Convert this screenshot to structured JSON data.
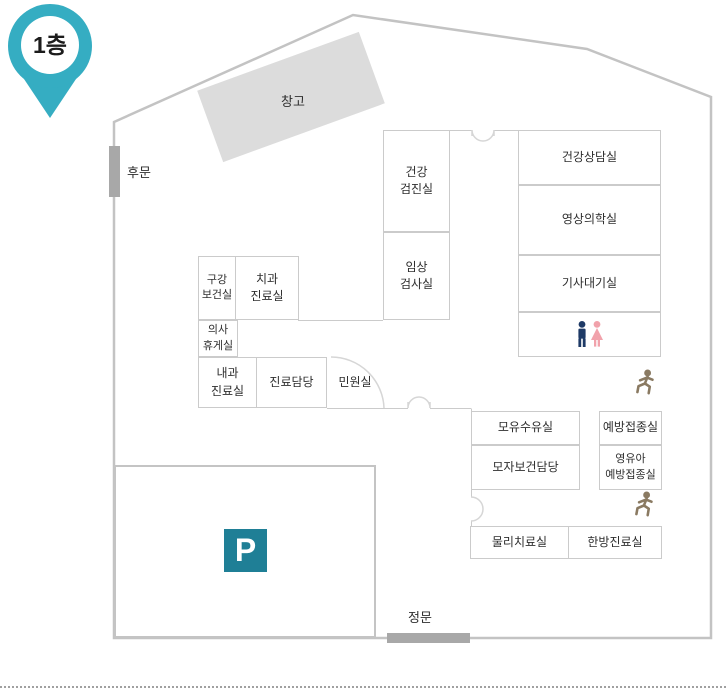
{
  "pin": {
    "label": "1층"
  },
  "storage": {
    "label": "창고"
  },
  "gates": {
    "back": "후문",
    "front": "정문"
  },
  "parking": {
    "symbol": "P"
  },
  "rooms": [
    {
      "label": "건강\n검진실"
    },
    {
      "label": "임상\n검사실"
    },
    {
      "label": "건강상담실"
    },
    {
      "label": "영상의학실"
    },
    {
      "label": "기사대기실"
    },
    {
      "label": "구강\n보건실"
    },
    {
      "label": "치과\n진료실"
    },
    {
      "label": "의사\n휴게실"
    },
    {
      "label": "내과\n진료실"
    },
    {
      "label": "진료담당"
    },
    {
      "label": "민원실"
    },
    {
      "label": "모유수유실"
    },
    {
      "label": "모자보건담당"
    },
    {
      "label": "예방접종실"
    },
    {
      "label": "영유아\n예방접종실"
    },
    {
      "label": "물리치료실"
    },
    {
      "label": "한방진료실"
    }
  ],
  "icons": {
    "map_pin": "map-pin",
    "restroom_man": "man-restroom",
    "restroom_woman": "woman-restroom",
    "stairs_upper": "running-person",
    "stairs_lower": "running-person",
    "parking": "parking-P"
  },
  "colors": {
    "pin": "#35adc2",
    "parking_badge": "#1f7f96",
    "restroom_man": "#1e3a66",
    "restroom_woman": "#f1a2ab",
    "runner": "#8a7a62",
    "wall": "#cbcbcb",
    "gate_bar": "#a8a8a8",
    "storage_fill": "#dcdcdc"
  }
}
